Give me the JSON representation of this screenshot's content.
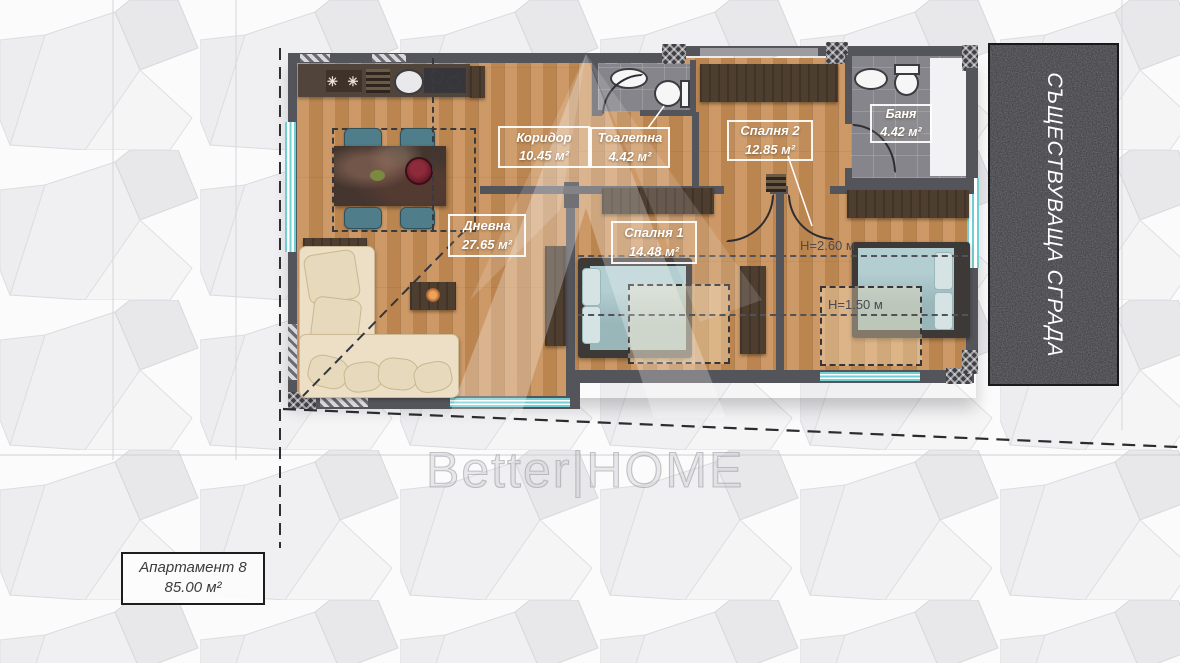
{
  "rooms": [
    {
      "name": "Коридор",
      "area": "10.45 м²"
    },
    {
      "name": "Тоалетна",
      "area": "4.42 м²"
    },
    {
      "name": "Спалня 2",
      "area": "12.85 м²"
    },
    {
      "name": "Баня",
      "area": "4.42 м²"
    },
    {
      "name": "Дневна",
      "area": "27.65 м²"
    },
    {
      "name": "Спалня 1",
      "area": "14.48 м²"
    }
  ],
  "annotations": {
    "ceiling_height_1": "Н=2.60 м",
    "ceiling_height_2": "Н=1.50 м"
  },
  "existing_building_label": "СЪЩЕСТВУВАЩА СГРАДА",
  "apartment": {
    "title": "Апартамент 8",
    "area": "85.00 м²"
  },
  "watermark": "Better|HOME",
  "kitchen_stove_symbol": "✳ ✳ ✳",
  "colors": {
    "wood_floor": "#c78d55",
    "wall": "#54545b",
    "tile_floor": "#85858b",
    "window_glass": "#6fcfd2",
    "existing_building": "#37373c",
    "label_border": "#ffffff"
  }
}
